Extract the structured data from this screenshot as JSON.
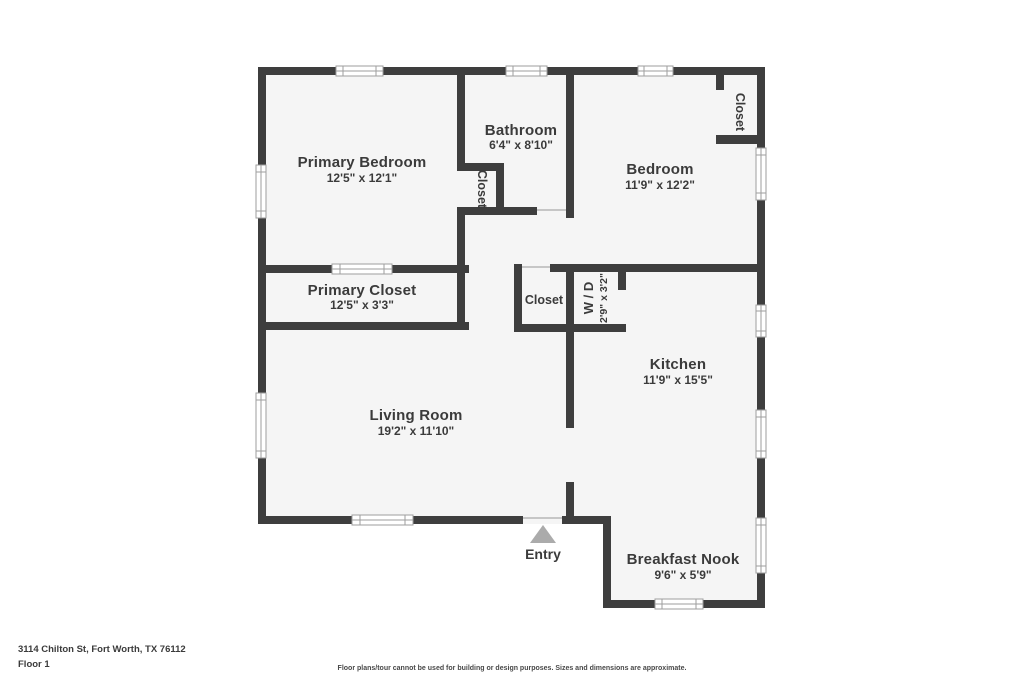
{
  "page": {
    "address": "3114 Chilton St, Fort Worth, TX 76112",
    "floor_label": "Floor 1",
    "disclaimer": "Floor plans/tour cannot be used for building or design purposes. Sizes and dimensions are approximate."
  },
  "rooms": {
    "primary_bedroom": {
      "name": "Primary Bedroom",
      "dims": "12'5\" x 12'1\""
    },
    "bathroom": {
      "name": "Bathroom",
      "dims": "6'4\" x 8'10\""
    },
    "bedroom": {
      "name": "Bedroom",
      "dims": "11'9\" x 12'2\""
    },
    "primary_closet": {
      "name": "Primary Closet",
      "dims": "12'5\" x 3'3\""
    },
    "kitchen": {
      "name": "Kitchen",
      "dims": "11'9\" x 15'5\""
    },
    "living_room": {
      "name": "Living Room",
      "dims": "19'2\" x 11'10\""
    },
    "breakfast_nook": {
      "name": "Breakfast Nook",
      "dims": "9'6\" x 5'9\""
    },
    "laundry": {
      "name": "W / D",
      "dims": "2'9\" x 3'2\""
    },
    "closet_label": "Closet",
    "entry_label": "Entry"
  },
  "colors": {
    "wall": "#3e3e3e",
    "room_fill": "#f5f5f5",
    "text": "#3b3b3b",
    "entry_arrow": "#ababab"
  }
}
